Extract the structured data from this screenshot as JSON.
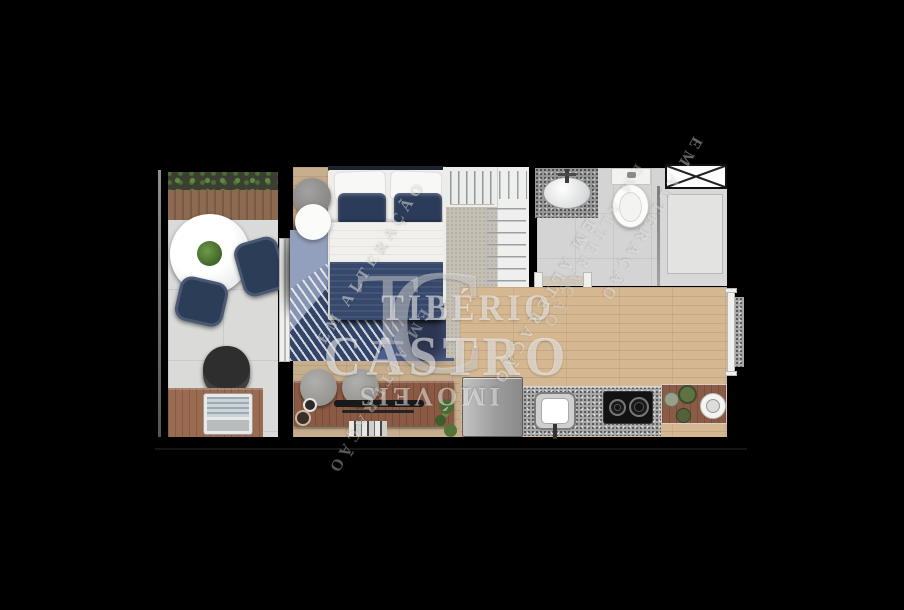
{
  "watermark": {
    "monogram": {
      "t": "T",
      "c": "C"
    },
    "brand": {
      "line1": "TIBÉRIO",
      "line2": "CASTRO",
      "line3": "IMÓVEIS"
    },
    "status": "EM ALTERAÇÃO"
  },
  "palette": {
    "background": "#000000",
    "wood_floor": "#c7ae8d",
    "wood_furniture": "#8a5c46",
    "navy_textile": "#2c3d58",
    "balcony_tile": "#dadbd9",
    "bath_tile": "#d3d4d3",
    "granite": "#a8a8a8",
    "closet_carpet": "#c6c0b4",
    "deck_wood": "#8b6a51",
    "plant_green": "#4c6b33",
    "watermark": "#ffffff"
  }
}
